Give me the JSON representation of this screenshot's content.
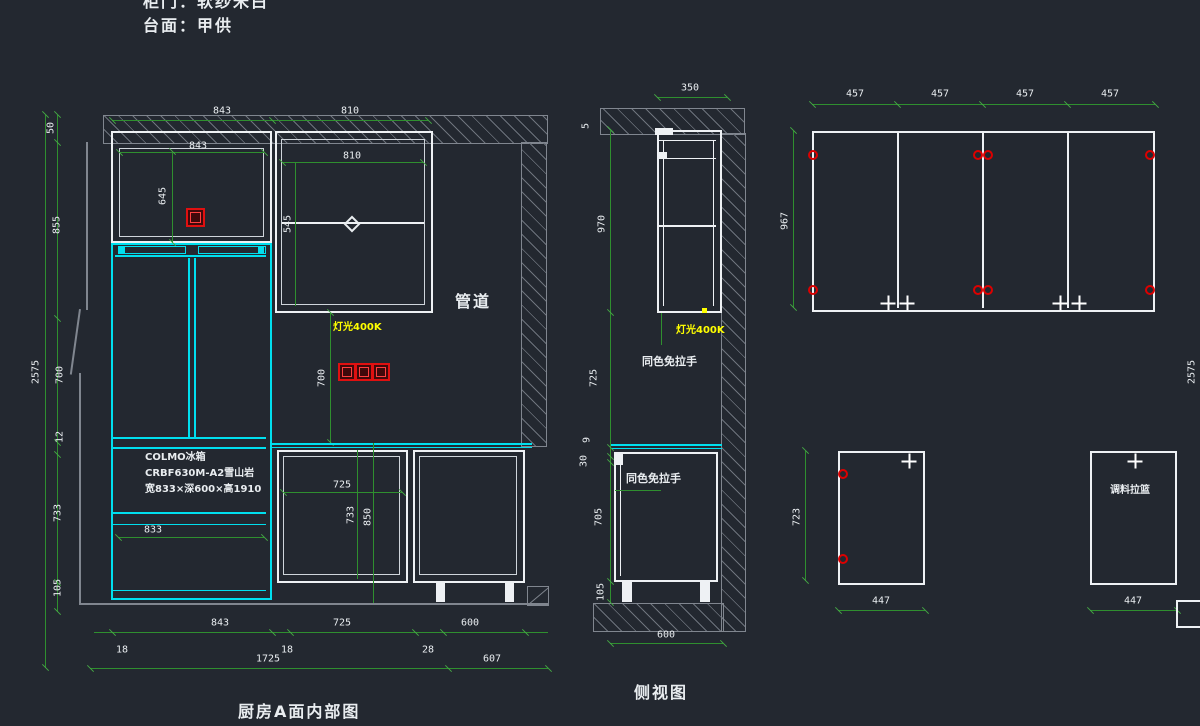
{
  "header": {
    "line1": "柜门：软纱米白",
    "line2": "台面：甲供"
  },
  "left_view": {
    "title": "厨房A面内部图",
    "duct": "管道",
    "light": "灯光400K",
    "note": {
      "l1": "COLMO冰箱",
      "l2": "CRBF630M-A2雪山岩",
      "l3": "宽833×深600×高1910"
    },
    "dims": {
      "top_w1": "843",
      "top_w2": "810",
      "inner_w1": "843",
      "inner_w2": "810",
      "inner_h1": "645",
      "inner_h2": "545",
      "ceiling": "50",
      "upper": "855",
      "total_h": "2575",
      "mid": "700",
      "counter": "12",
      "base": "733",
      "leg": "105",
      "socket_drop": "700",
      "fridge_w": "833",
      "base_w": "725",
      "base_h": "733",
      "base_th": "850",
      "bot_w1": "843",
      "bot_w2": "725",
      "bot_w3": "600",
      "off1": "18",
      "off2": "18",
      "off3": "28",
      "total_w": "1725",
      "right_w": "607"
    }
  },
  "side_view": {
    "title": "侧视图",
    "light": "灯光400K",
    "handle": "同色免拉手",
    "dims": {
      "depth": "350",
      "gap_top": "5",
      "wall_h": "970",
      "mid_gap": "725",
      "counter_t": "9",
      "drop": "30",
      "base_h": "705",
      "leg": "105",
      "bottom_w": "600"
    }
  },
  "panels": {
    "door_w": [
      "457",
      "457",
      "457",
      "457"
    ],
    "door_h": "967",
    "base_door_h": "723",
    "base_w1": "447",
    "base_w2": "447",
    "spice": "调料拉篮",
    "edge": "2575"
  }
}
